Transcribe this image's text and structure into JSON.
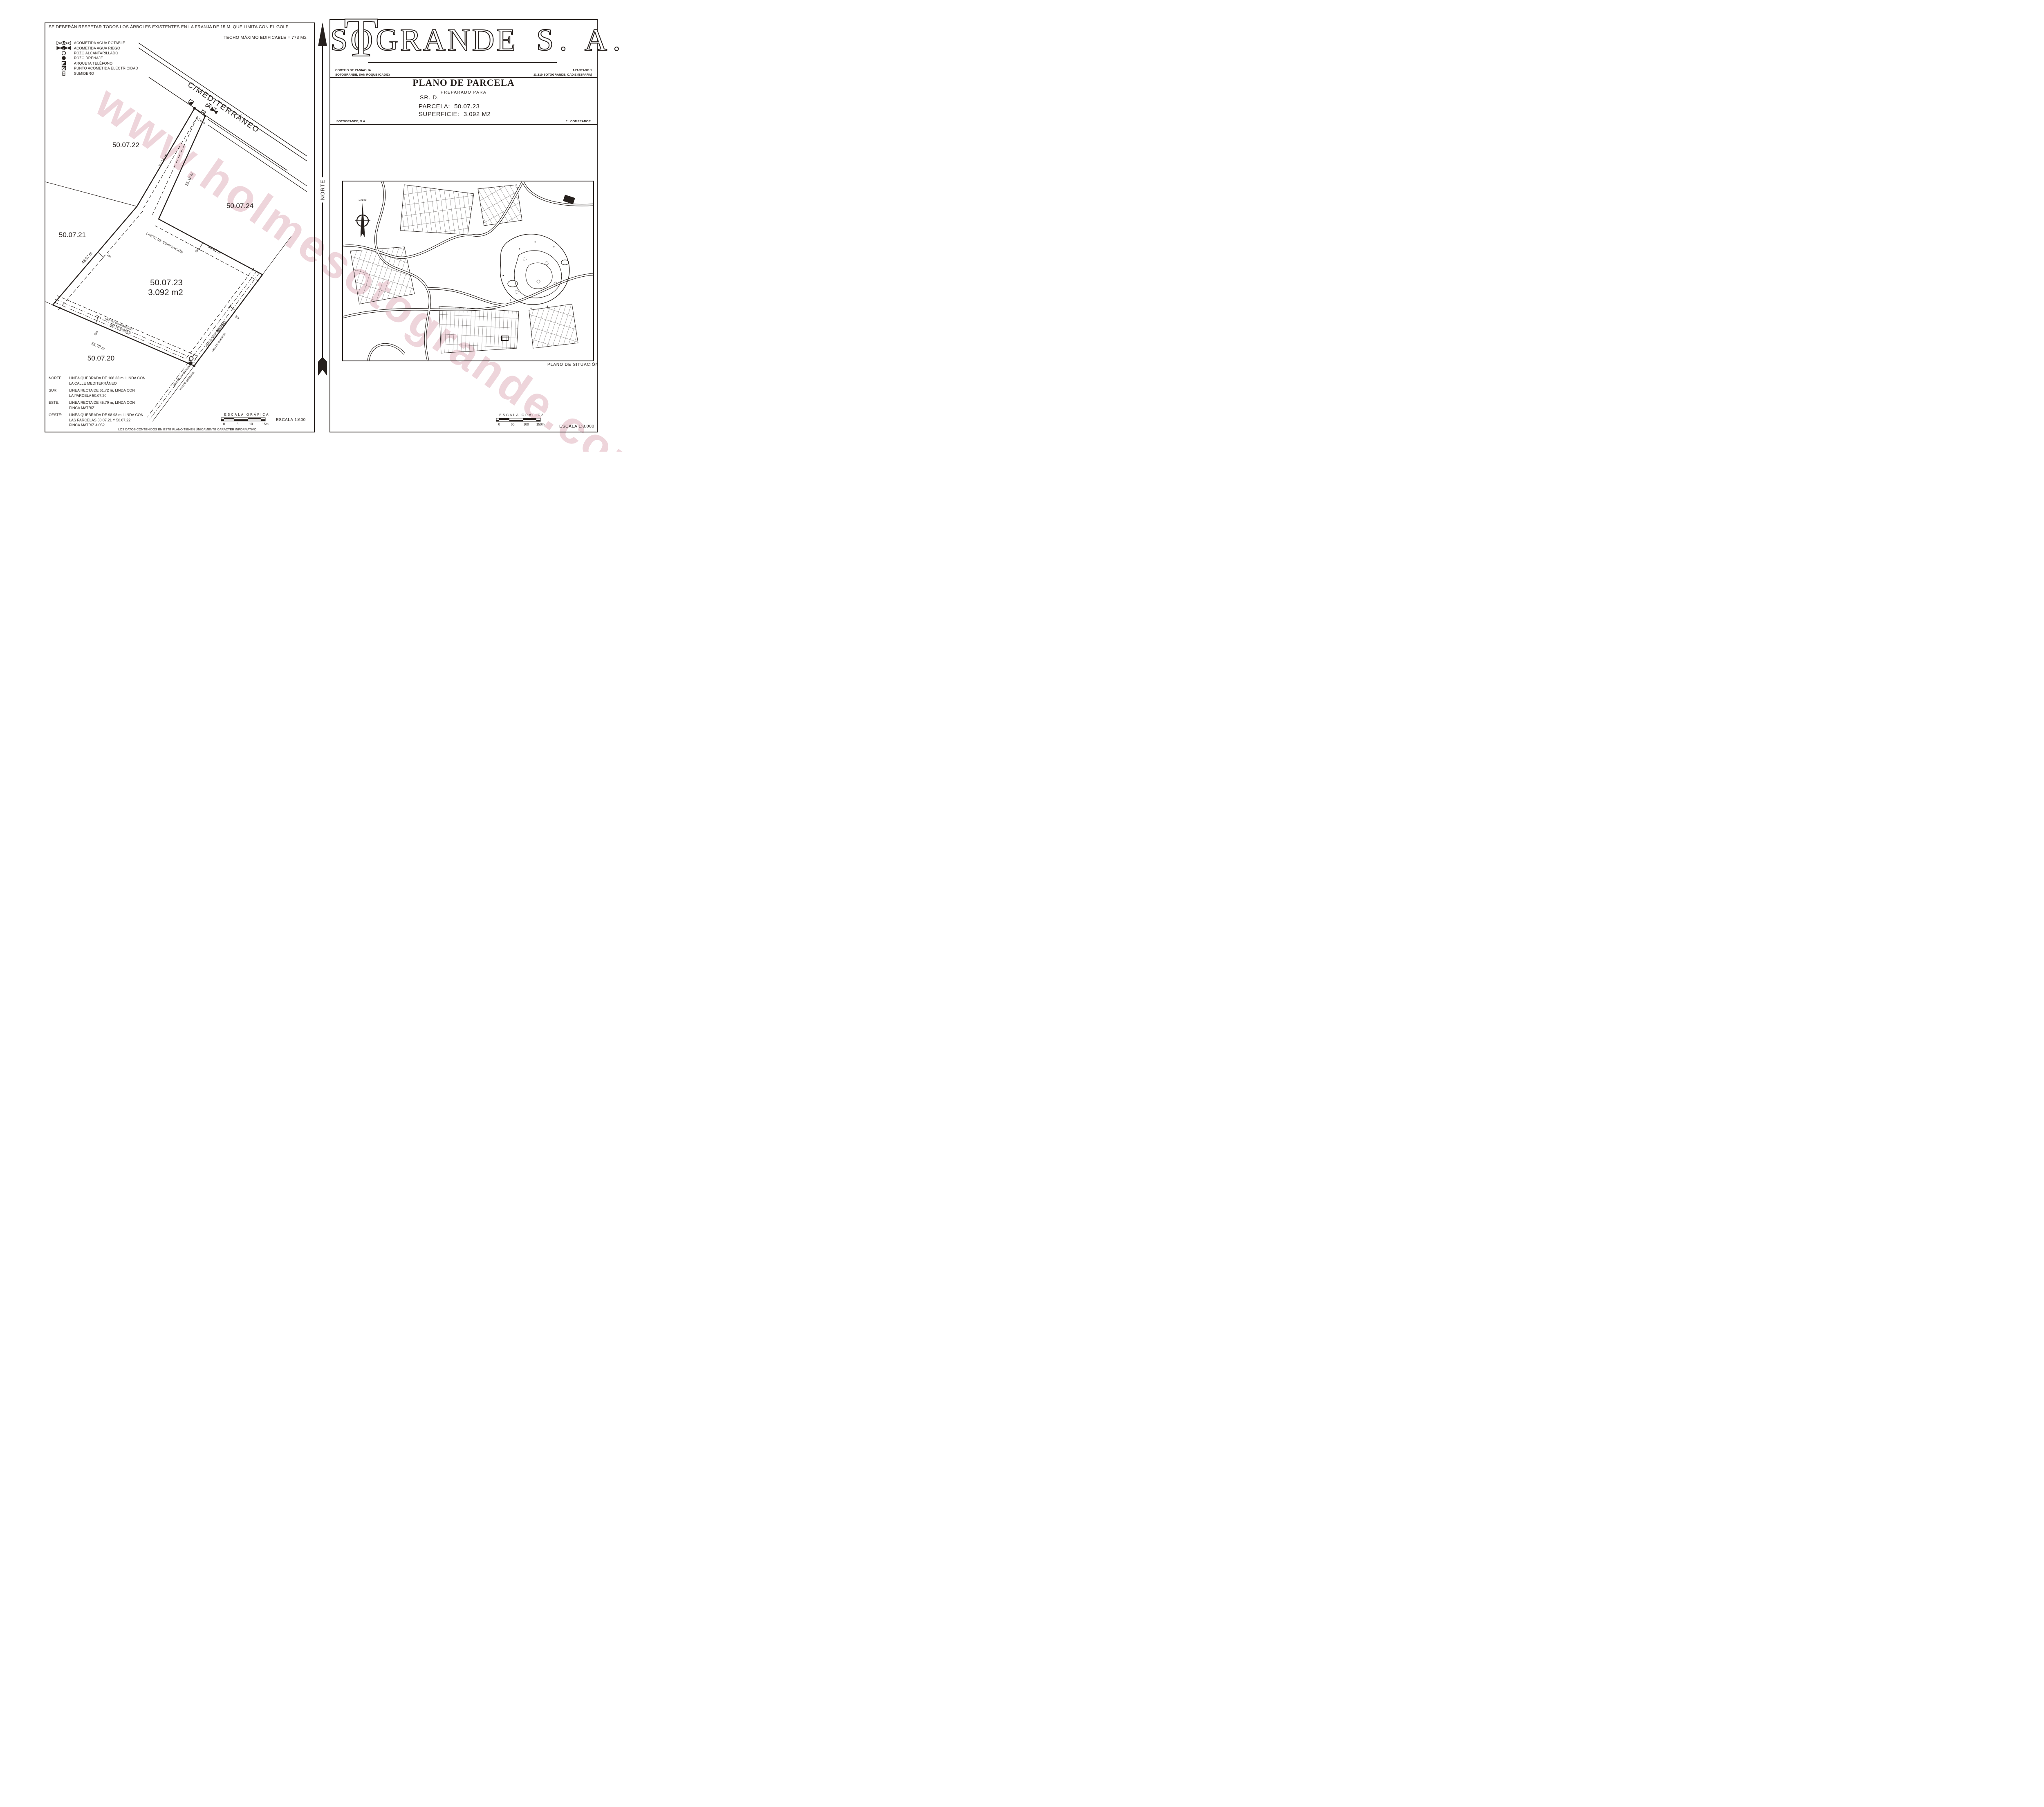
{
  "watermark": {
    "text": "www.holmesotogrande.com",
    "color": "#eed5db"
  },
  "ink_color": "#26201d",
  "left_sheet": {
    "disclaimer": "SE DEBERÁN RESPETAR TODOS LOS ÁRBOLES EXISTENTES EN LA FRANJA DE 15 M. QUE LIMITA CON EL GOLF",
    "techo_maximo": "TECHO MÁXIMO EDIFICABLE = 773 M2",
    "legend": [
      {
        "icon": "valve-outline",
        "label": "ACOMETIDA AGUA POTABLE"
      },
      {
        "icon": "valve-filled",
        "label": "ACOMETIDA AGUA RIEGO"
      },
      {
        "icon": "circle-outline",
        "label": "POZO ALCANTARILLADO"
      },
      {
        "icon": "circle-filled",
        "label": "POZO DRENAJE"
      },
      {
        "icon": "square-half-filled",
        "label": "ARQUETA TELÉFONO"
      },
      {
        "icon": "square-x",
        "label": "PUNTO ACOMETIDA ELECTRICIDAD"
      },
      {
        "icon": "square-striped",
        "label": "SUMIDERO"
      }
    ],
    "street_label": "C/MEDITERRÁNEO",
    "limit_label": "LÍMITE DE EDIFICACIÓN",
    "utility_label_1": "RED DE SANEAMIENTO",
    "utility_label_2": "RED DE DRENAJE",
    "parcel": {
      "number": "50.07.23",
      "area": "3.092 m2"
    },
    "neighbors": {
      "northwest": "50.07.22",
      "northeast": "50.07.24",
      "west": "50.07.21",
      "south": "50.07.20"
    },
    "dimensions": {
      "access_width": "8.26 m",
      "west_upper": "50.36 m",
      "neck_east": "51.16 m",
      "north_lower": "48.91 m",
      "west_lower": "48.62 m",
      "south": "61.72 m",
      "east": "45.79 m",
      "setback": "3m"
    },
    "boundaries": [
      {
        "dir": "NORTE:",
        "lines": [
          "LINEA QUEBRADA DE 108.33 m, LINDA CON",
          "LA CALLE MEDITERRÁNEO"
        ]
      },
      {
        "dir": "SUR:",
        "lines": [
          "LINEA RECTA DE 61.72 m, LINDA CON",
          "LA PARCELA 50.07.20"
        ]
      },
      {
        "dir": "ESTE:",
        "lines": [
          "LINEA RECTA DE 45.79 m, LINDA CON",
          "FINCA MATRIZ"
        ]
      },
      {
        "dir": "OESTE:",
        "lines": [
          "LINEA QUEBRADA DE 98.98 m, LINDA CON",
          "LAS PARCELAS 50.07.21 Y 50.07.22",
          "FINCA MATRIZ 4.052"
        ]
      }
    ],
    "scale_bar": {
      "title": "ESCALA GRÁFICA",
      "ticks": [
        "0",
        "5",
        "10",
        "15m"
      ]
    },
    "scale_text": "ESCALA 1:600",
    "footnote": "LOS DATOS CONTENIDOS EN ESTE PLANO TIENEN ÚNICAMENTE CARÁCTER INFORMATIVO"
  },
  "divider": {
    "label": "NORTE"
  },
  "right_sheet": {
    "logo": {
      "s": "S",
      "o": "O",
      "t": "T",
      "grande": "GRANDE",
      "suffix": "S. A."
    },
    "address_left_1": "CORTIJO DE PANIAGUA",
    "address_left_2": "SOTOGRANDE, SAN ROQUE (CADIZ)",
    "address_right_1": "APARTADO 1",
    "address_right_2": "11.310 SOTOGRANDE, CADIZ (ESPAÑA)",
    "title": "PLANO DE PARCELA",
    "subtitle": "PREPARADO PARA",
    "client": "SR. D.",
    "parcela_label": "PARCELA:",
    "parcela_value": "50.07.23",
    "superficie_label": "SUPERFICIE:",
    "superficie_value": "3.092 M2",
    "firm_left": "SOTOGRANDE, S.A.",
    "firm_right": "EL COMPRADOR",
    "compass_label": "NORTE",
    "map_label": "PLANO DE SITUACIÓN",
    "scale_bar": {
      "title": "ESCALA GRÁFICA",
      "ticks": [
        "0",
        "50",
        "100",
        "150m"
      ]
    },
    "scale_text": "ESCALA 1:8.000"
  }
}
